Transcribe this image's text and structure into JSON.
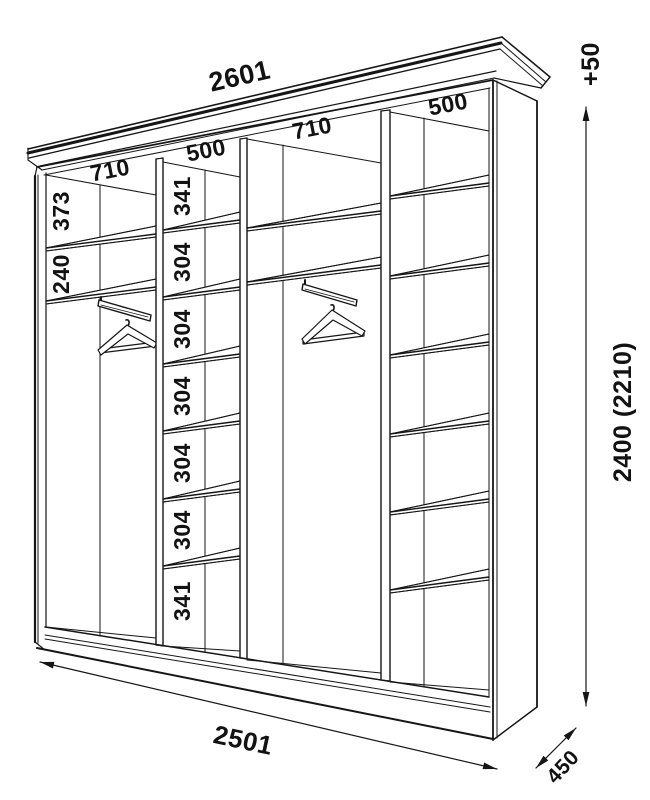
{
  "labels": {
    "cornice_width": "2601",
    "base_width": "2501",
    "depth": "450",
    "height": "2400 (2210)",
    "height_extra": "+50",
    "sections": [
      "710",
      "500",
      "710",
      "500"
    ],
    "left_gaps": [
      "373",
      "240"
    ],
    "middle_gaps": [
      "341",
      "304",
      "304",
      "304",
      "304",
      "304",
      "341"
    ]
  }
}
